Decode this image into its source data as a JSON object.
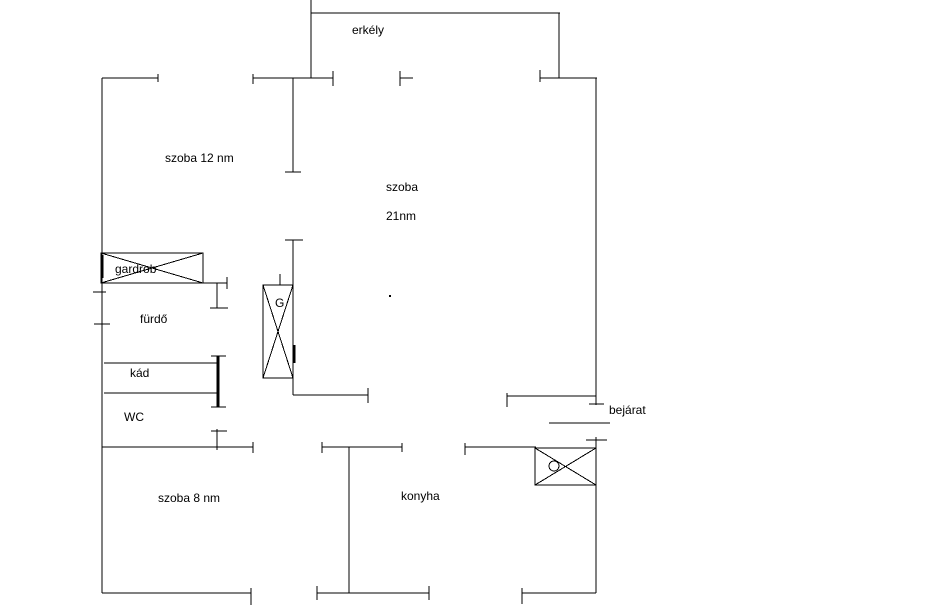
{
  "document": {
    "type": "apartment-floor-plan",
    "background_color": "#ffffff",
    "line_color": "#000000",
    "text_color": "#000000"
  },
  "labels": {
    "erkely": {
      "text": "erkély",
      "x": 352,
      "y": 24
    },
    "szoba12": {
      "text": "szoba 12 nm",
      "x": 165,
      "y": 152
    },
    "szoba21a": {
      "text": "szoba",
      "x": 386,
      "y": 181
    },
    "szoba21b": {
      "text": "21nm",
      "x": 386,
      "y": 210
    },
    "gardrob": {
      "text": "gardrob",
      "x": 115,
      "y": 263
    },
    "furdo": {
      "text": "fürdő",
      "x": 140,
      "y": 313
    },
    "kad": {
      "text": "kád",
      "x": 130,
      "y": 367
    },
    "wc": {
      "text": "WC",
      "x": 124,
      "y": 411
    },
    "szoba8": {
      "text": "szoba 8 nm",
      "x": 158,
      "y": 492
    },
    "konyha": {
      "text": "konyha",
      "x": 401,
      "y": 490
    },
    "bejarat": {
      "text": "bejárat",
      "x": 609,
      "y": 404
    },
    "g_symbol": {
      "text": "G",
      "x": 275,
      "y": 297
    }
  },
  "geometry": {
    "canvas": {
      "width": 947,
      "height": 613
    },
    "walls": [
      {
        "x1": 311,
        "y1": 0,
        "x2": 311,
        "y2": 78
      },
      {
        "x1": 311,
        "y1": 13,
        "x2": 560,
        "y2": 13
      },
      {
        "x1": 559,
        "y1": 13,
        "x2": 559,
        "y2": 78
      },
      {
        "x1": 102,
        "y1": 78,
        "x2": 158,
        "y2": 78
      },
      {
        "x1": 158,
        "y1": 74,
        "x2": 158,
        "y2": 82
      },
      {
        "x1": 253,
        "y1": 74,
        "x2": 253,
        "y2": 84
      },
      {
        "x1": 253,
        "y1": 78,
        "x2": 333,
        "y2": 78
      },
      {
        "x1": 333,
        "y1": 71,
        "x2": 333,
        "y2": 86
      },
      {
        "x1": 400,
        "y1": 71,
        "x2": 400,
        "y2": 86
      },
      {
        "x1": 400,
        "y1": 78,
        "x2": 413,
        "y2": 78
      },
      {
        "x1": 540,
        "y1": 70,
        "x2": 540,
        "y2": 82
      },
      {
        "x1": 540,
        "y1": 78,
        "x2": 597,
        "y2": 78
      },
      {
        "x1": 102,
        "y1": 78,
        "x2": 102,
        "y2": 593
      },
      {
        "x1": 93,
        "y1": 292,
        "x2": 106,
        "y2": 292
      },
      {
        "x1": 94,
        "y1": 324,
        "x2": 110,
        "y2": 324
      },
      {
        "x1": 596,
        "y1": 78,
        "x2": 596,
        "y2": 405
      },
      {
        "x1": 589,
        "y1": 404,
        "x2": 604,
        "y2": 404
      },
      {
        "x1": 586,
        "y1": 440,
        "x2": 607,
        "y2": 440
      },
      {
        "x1": 596,
        "y1": 437,
        "x2": 596,
        "y2": 593
      },
      {
        "x1": 293,
        "y1": 78,
        "x2": 293,
        "y2": 172
      },
      {
        "x1": 285,
        "y1": 172,
        "x2": 301,
        "y2": 172
      },
      {
        "x1": 285,
        "y1": 240,
        "x2": 303,
        "y2": 240
      },
      {
        "x1": 293,
        "y1": 240,
        "x2": 293,
        "y2": 395
      },
      {
        "x1": 294,
        "y1": 345,
        "x2": 294,
        "y2": 363,
        "w": 3
      },
      {
        "x1": 280,
        "y1": 274,
        "x2": 280,
        "y2": 285
      },
      {
        "x1": 101,
        "y1": 283,
        "x2": 227,
        "y2": 283
      },
      {
        "x1": 227,
        "y1": 277,
        "x2": 227,
        "y2": 289
      },
      {
        "x1": 217,
        "y1": 283,
        "x2": 217,
        "y2": 308
      },
      {
        "x1": 210,
        "y1": 308,
        "x2": 228,
        "y2": 308
      },
      {
        "x1": 102,
        "y1": 255,
        "x2": 102,
        "y2": 278,
        "w": 3
      },
      {
        "x1": 104,
        "y1": 363,
        "x2": 218,
        "y2": 363
      },
      {
        "x1": 104,
        "y1": 393,
        "x2": 218,
        "y2": 393
      },
      {
        "x1": 218,
        "y1": 356,
        "x2": 218,
        "y2": 407,
        "w": 3
      },
      {
        "x1": 211,
        "y1": 356,
        "x2": 226,
        "y2": 356
      },
      {
        "x1": 211,
        "y1": 407,
        "x2": 226,
        "y2": 407
      },
      {
        "x1": 217,
        "y1": 429,
        "x2": 217,
        "y2": 450
      },
      {
        "x1": 211,
        "y1": 431,
        "x2": 227,
        "y2": 431
      },
      {
        "x1": 102,
        "y1": 447,
        "x2": 253,
        "y2": 447
      },
      {
        "x1": 253,
        "y1": 442,
        "x2": 253,
        "y2": 453
      },
      {
        "x1": 322,
        "y1": 442,
        "x2": 322,
        "y2": 453
      },
      {
        "x1": 322,
        "y1": 447,
        "x2": 402,
        "y2": 447
      },
      {
        "x1": 402,
        "y1": 443,
        "x2": 402,
        "y2": 452
      },
      {
        "x1": 465,
        "y1": 443,
        "x2": 465,
        "y2": 455
      },
      {
        "x1": 465,
        "y1": 447,
        "x2": 536,
        "y2": 447
      },
      {
        "x1": 293,
        "y1": 395,
        "x2": 368,
        "y2": 395
      },
      {
        "x1": 368,
        "y1": 388,
        "x2": 368,
        "y2": 403
      },
      {
        "x1": 507,
        "y1": 396,
        "x2": 596,
        "y2": 396
      },
      {
        "x1": 507,
        "y1": 393,
        "x2": 507,
        "y2": 407
      },
      {
        "x1": 549,
        "y1": 423,
        "x2": 610,
        "y2": 423
      },
      {
        "x1": 349,
        "y1": 447,
        "x2": 349,
        "y2": 593
      },
      {
        "x1": 102,
        "y1": 593,
        "x2": 251,
        "y2": 593
      },
      {
        "x1": 251,
        "y1": 588,
        "x2": 251,
        "y2": 605
      },
      {
        "x1": 317,
        "y1": 586,
        "x2": 317,
        "y2": 600
      },
      {
        "x1": 317,
        "y1": 593,
        "x2": 429,
        "y2": 593
      },
      {
        "x1": 429,
        "y1": 586,
        "x2": 429,
        "y2": 600
      },
      {
        "x1": 522,
        "y1": 593,
        "x2": 596,
        "y2": 593
      },
      {
        "x1": 522,
        "y1": 588,
        "x2": 522,
        "y2": 604
      }
    ],
    "crossed_boxes": [
      {
        "name": "gardrob-cabinet",
        "x": 101,
        "y": 253,
        "w": 102,
        "h": 30
      },
      {
        "name": "boiler-cabinet",
        "x": 263,
        "y": 285,
        "w": 30,
        "h": 93
      },
      {
        "name": "entrance-cabinet",
        "x": 535,
        "y": 448,
        "w": 61,
        "h": 37
      }
    ],
    "circles": [
      {
        "name": "entrance-cabinet-knob",
        "cx": 554,
        "cy": 466,
        "r": 5
      }
    ],
    "dots": [
      {
        "name": "stray-dot",
        "x": 389,
        "y": 295
      }
    ]
  }
}
